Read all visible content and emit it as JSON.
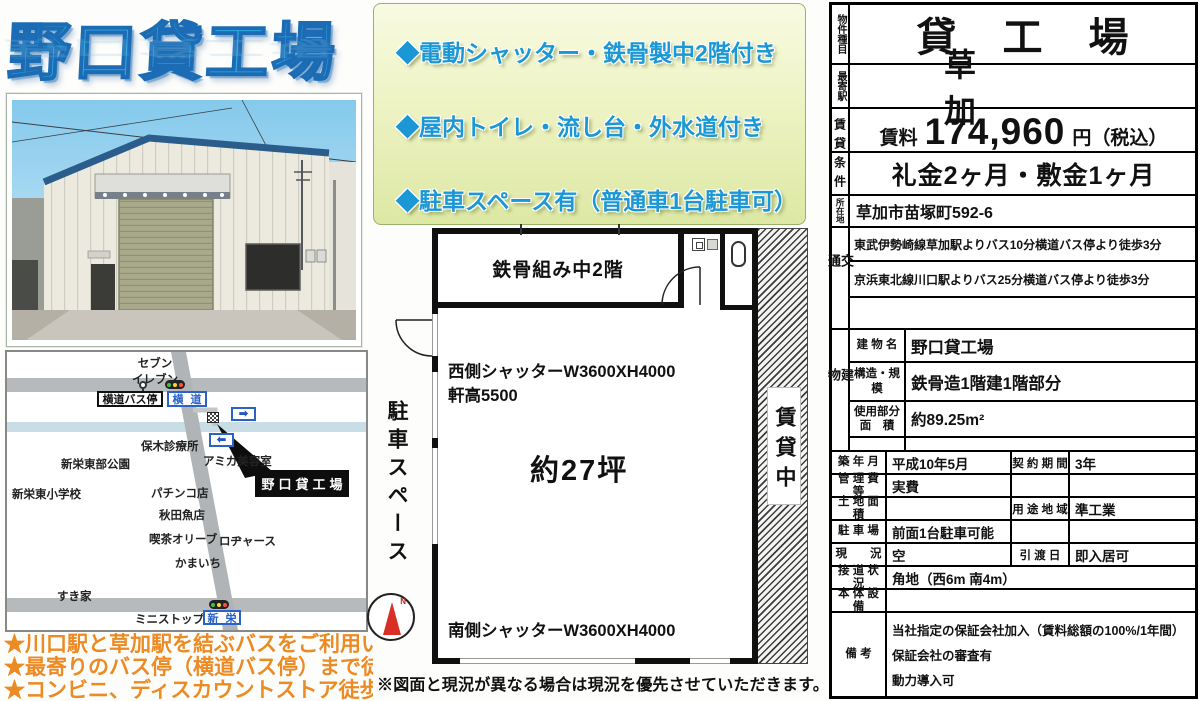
{
  "title": "野口貸工場",
  "features": {
    "line1": "◆電動シャッター・鉄骨製中2階付き",
    "line2": "◆屋内トイレ・流し台・外水道付き",
    "line3": "◆駐車スペース有（普通車1台駐車可）"
  },
  "map": {
    "seven_eleven_1": "セブン",
    "seven_eleven_2": "イレブン",
    "bus_stop_box": "横道バス停",
    "yokomichi_sign": "横道",
    "hoki_clinic": "保木診療所",
    "amika_salon": "アミカ美容室",
    "shinei_park": "新栄東部公園",
    "shinei_school": "新栄東小学校",
    "pachinko": "パチンコ店",
    "fish_shop": "秋田魚店",
    "cafe_olive": "喫茶オリーブ",
    "rogers": "ロヂャース",
    "kamaichi": "かまいち",
    "sukiya": "すき家",
    "ministop": "ミニストップ",
    "shinei_sign": "新栄",
    "property_box": "野口貸工場",
    "arrow_right": "➡",
    "arrow_left": "⬅"
  },
  "notes": {
    "line1": "★川口駅と草加駅を結ぶバスをご利用いただけます",
    "line2": "★最寄りのバス停（横道バス停）まで徒歩3分！",
    "line3": "★コンビニ、ディスカウントストア徒歩圏内！"
  },
  "floor_plan": {
    "mezzanine": "鉄骨組み中2階",
    "west_shutter": "西側シャッターW3600XH4000",
    "eave_height": "軒高5500",
    "area": "約27坪",
    "south_shutter": "南側シャッターW3600XH4000",
    "parking_space": "駐車スペース",
    "rented": "賃貸中",
    "compass_n": "N",
    "note": "※図面と現況が異なる場合は現況を優先させていただきます。"
  },
  "table": {
    "property_type_label": "物件種目",
    "property_type": "貸工場",
    "station_label": "最寄駅",
    "station": "草加",
    "terms_label": "賃貸条件",
    "rent_label": "賃料",
    "rent_value": "174,960",
    "rent_unit": "円（税込）",
    "deposit": "礼金2ヶ月・敷金1ヶ月",
    "address_label": "所在地",
    "address": "草加市苗塚町592-6",
    "access_label": "交通",
    "access": [
      "東武伊勢崎線草加駅よりバス10分横道バス停より徒歩3分",
      "京浜東北線川口駅よりバス25分横道バス停より徒歩3分"
    ],
    "building_label": "建物",
    "building_name_label": "建 物 名",
    "building_name": "野口貸工場",
    "structure_label": "構造・規模",
    "structure": "鉄骨造1階建1階部分",
    "used_area_label1": "使用部分",
    "used_area_label2": "面　積",
    "used_area": "約89.25m²",
    "built_label": "築 年 月",
    "built": "平成10年5月",
    "contract_label": "契 約 期 間",
    "contract": "3年",
    "mgmt_label": "管 理 費 等",
    "mgmt": "実費",
    "land_label": "土 地 面 積",
    "zoning_label": "用 途 地 域",
    "zoning": "準工業",
    "parking_label": "駐 車 場",
    "parking": "前面1台駐車可能",
    "status_label": "現　　況",
    "status": "空",
    "handover_label": "引 渡 日",
    "handover": "即入居可",
    "road_label": "接 道 状 況",
    "road": "角地（西6m 南4m）",
    "equipment_label": "本 体 設 備",
    "remarks_label": "備 考",
    "remarks": [
      "当社指定の保証会社加入（賃料総額の100%/1年間）",
      "保証会社の審査有",
      "動力導入可"
    ]
  }
}
